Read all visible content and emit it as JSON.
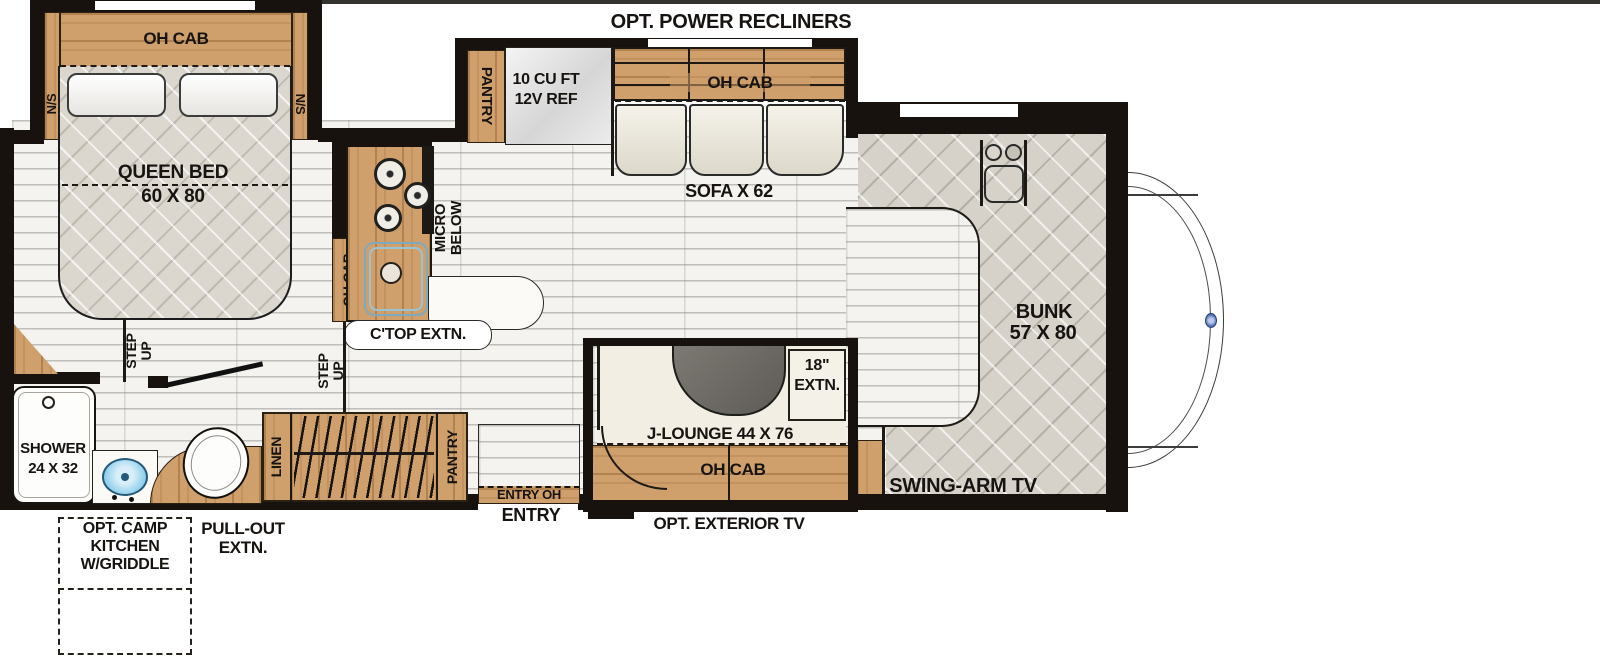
{
  "colors": {
    "wall": "#17120d",
    "wood": "#cf9f6b",
    "floor": "#f4f3f0",
    "mattress_quilt": "#dbd7cf",
    "bunk_quilt": "#d6d2ca",
    "seat_white": "#f2eee4",
    "table_gray": "#6e6b65",
    "sink_blue": "#8fd0ec",
    "logo_blue": "#4a6cb0"
  },
  "exterior": {
    "opt_power_recliners": "OPT. POWER RECLINERS",
    "opt_exterior_tv": "OPT. EXTERIOR TV",
    "entry": "ENTRY",
    "pull_out_1": "PULL-OUT",
    "pull_out_2": "EXTN.",
    "camp_kitchen_1": "OPT. CAMP",
    "camp_kitchen_2": "KITCHEN",
    "camp_kitchen_3": "W/GRIDDLE"
  },
  "bedroom": {
    "oh_cab": "OH CAB",
    "ns_left": "N/S",
    "ns_right": "N/S",
    "queen_bed": "QUEEN BED",
    "queen_bed_size": "60 X 80",
    "step_1": "STEP",
    "step_2": "UP"
  },
  "bath": {
    "shower": "SHOWER",
    "shower_size": "24 X 32",
    "linen": "LINEN"
  },
  "kitchen": {
    "micro_1": "MICRO",
    "micro_2": "BELOW",
    "oh_cab": "OH CAB",
    "ctop_extn": "C'TOP EXTN.",
    "step_1": "STEP",
    "step_2": "UP"
  },
  "sofa_slide": {
    "pantry": "PANTRY",
    "fridge_1": "10 CU FT",
    "fridge_2": "12V REF",
    "oh_cab": "OH CAB",
    "sofa_label": "SOFA X 62"
  },
  "lounge": {
    "label": "J-LOUNGE 44 X 76",
    "extn_1": "18\"",
    "extn_2": "EXTN.",
    "oh_cab": "OH CAB"
  },
  "entry": {
    "entry_oh": "ENTRY OH",
    "pantry": "PANTRY"
  },
  "front": {
    "bunk": "BUNK",
    "bunk_size": "57 X 80",
    "swing_tv": "SWING-ARM TV"
  }
}
